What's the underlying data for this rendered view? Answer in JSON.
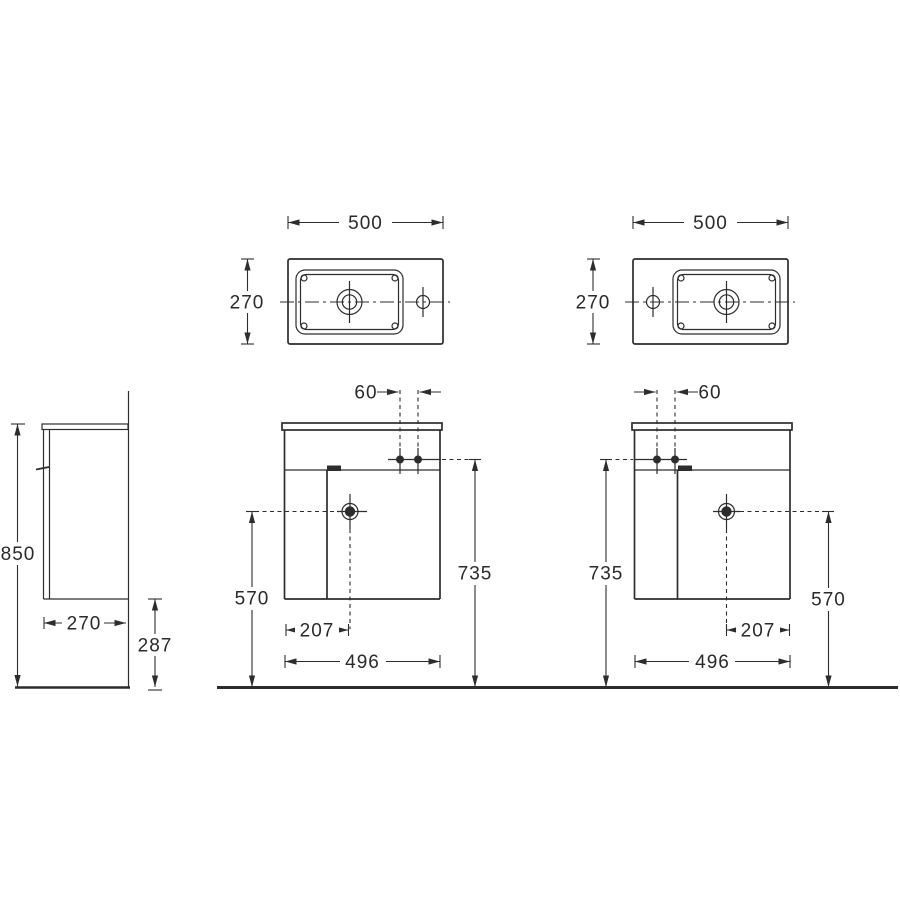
{
  "drawing_title": "washbasin-vanity-unit-dimension-drawing",
  "colors": {
    "line": "#2d2d2d",
    "text": "#2a2a2a",
    "background": "#ffffff"
  },
  "top_left_view": {
    "width": "500",
    "depth": "270"
  },
  "top_right_view": {
    "width": "500",
    "depth": "270"
  },
  "side_view": {
    "height": "850",
    "depth": "270",
    "bottom_clearance": "287"
  },
  "front_left_view": {
    "tap_spacing": "60",
    "tap_height": "735",
    "drain_height": "570",
    "drain_offset": "207",
    "width": "496"
  },
  "front_right_view": {
    "tap_spacing": "60",
    "tap_height": "735",
    "drain_height": "570",
    "drain_offset": "207",
    "width": "496"
  }
}
